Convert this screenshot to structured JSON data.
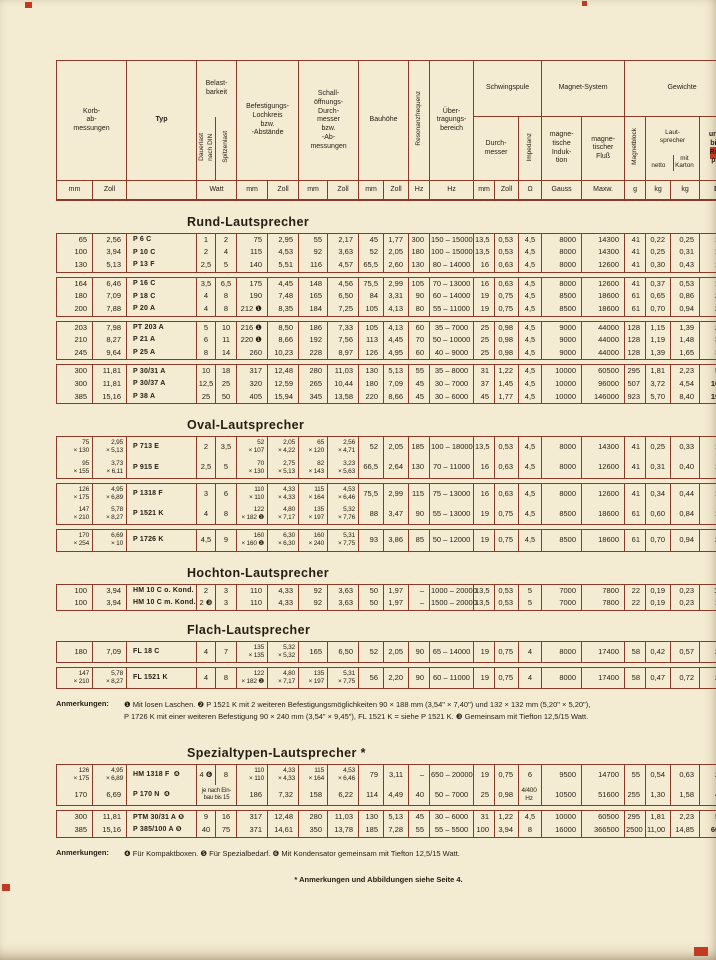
{
  "colors": {
    "paper": "#f3ebd2",
    "rule": "#8a3a26",
    "ink": "#241d12",
    "mark_red": "#c03a24"
  },
  "header": {
    "korb": "Korb-\nab-\nmessungen",
    "typ": "Typ",
    "belastbarkeit": "Belast-\nbarkeit",
    "dauerlast": "Dauerlast\nnach DIN",
    "spitzenlast": "Spitzenlast",
    "befestigung": "Befestigungs-\nLochkreis\nbzw.\n-Abstände",
    "schall": "Schall-\nöffnungs-\nDurch-\nmesser\nbzw.\n-Ab-\nmessungen",
    "bauhoehe": "Bauhöhe",
    "resonanz": "Resonanzfrequenz",
    "uebertragung": "Über-\ntragungs-\nbereich",
    "schwingspule": "Schwingspule",
    "durchmesser": "Durch-\nmesser",
    "impedanz": "Impedanz",
    "magnetsystem": "Magnet-System",
    "induktion": "magne-\ntische\nInduk-\ntion",
    "fluss": "magne-\ntischer\nFluß",
    "gewichte": "Gewichte",
    "magnetblock": "Magnetblock",
    "lautsprecher": "Laut-\nsprecher",
    "netto": "netto",
    "mit_karton": "mit\nKarton",
    "preis": "unver-\nbindl.\nRicht-\npreis",
    "units": [
      "mm",
      "Zoll",
      "Watt",
      "mm",
      "Zoll",
      "mm",
      "Zoll",
      "mm",
      "Zoll",
      "Hz",
      "Hz",
      "mm",
      "Zoll",
      "Ω",
      "Gauss",
      "Maxw.",
      "g",
      "kg",
      "kg",
      "DM"
    ]
  },
  "sections": [
    {
      "title": "Rund-Lautsprecher",
      "groups": [
        [
          [
            "65",
            "2,56",
            "P 6 C",
            "1",
            "2",
            "75",
            "2,95",
            "55",
            "2,17",
            "45",
            "1,77",
            "300",
            "150 – 15000",
            "13,5",
            "0,53",
            "4,5",
            "8000",
            "14300",
            "41",
            "0,22",
            "0,25",
            "14,—"
          ],
          [
            "100",
            "3,94",
            "P 10 C",
            "2",
            "4",
            "115",
            "4,53",
            "92",
            "3,63",
            "52",
            "2,05",
            "180",
            "100 – 15000",
            "13,5",
            "0,53",
            "4,5",
            "8000",
            "14300",
            "41",
            "0,25",
            "0,31",
            "15,—"
          ],
          [
            "130",
            "5,13",
            "P 13 F",
            "2,5",
            "5",
            "140",
            "5,51",
            "116",
            "4,57",
            "65,5",
            "2,60",
            "130",
            "80 – 14000",
            "16",
            "0,63",
            "4,5",
            "8000",
            "12600",
            "41",
            "0,30",
            "0,43",
            "17,—"
          ]
        ],
        [
          [
            "164",
            "6,46",
            "P 16 C",
            "3,5",
            "6,5",
            "175",
            "4,45",
            "148",
            "4,56",
            "75,5",
            "2,99",
            "105",
            "70 – 13000",
            "16",
            "0,63",
            "4,5",
            "8000",
            "12600",
            "41",
            "0,37",
            "0,53",
            "19,—"
          ],
          [
            "180",
            "7,09",
            "P 18 C",
            "4",
            "8",
            "190",
            "7,48",
            "165",
            "6,50",
            "84",
            "3,31",
            "90",
            "60 – 14000",
            "19",
            "0,75",
            "4,5",
            "8500",
            "18600",
            "61",
            "0,65",
            "0,86",
            "21,—"
          ],
          [
            "200",
            "7,88",
            "P 20 A",
            "4",
            "8",
            "212 ❶",
            "8,35",
            "184",
            "7,25",
            "105",
            "4,13",
            "80",
            "55 – 11000",
            "19",
            "0,75",
            "4,5",
            "8500",
            "18600",
            "61",
            "0,70",
            "0,94",
            "22,—"
          ]
        ],
        [
          [
            "203",
            "7,98",
            "PT 203 A",
            "5",
            "10",
            "216 ❶",
            "8,50",
            "186",
            "7,33",
            "105",
            "4,13",
            "60",
            "35 – 7000",
            "25",
            "0,98",
            "4,5",
            "9000",
            "44000",
            "128",
            "1,15",
            "1,39",
            "29,—"
          ],
          [
            "210",
            "8,27",
            "P 21 A",
            "6",
            "11",
            "220 ❶",
            "8,66",
            "192",
            "7,56",
            "113",
            "4,45",
            "70",
            "50 – 10000",
            "25",
            "0,98",
            "4,5",
            "9000",
            "44000",
            "128",
            "1,19",
            "1,48",
            "30,—"
          ],
          [
            "245",
            "9,64",
            "P 25 A",
            "8",
            "14",
            "260",
            "10,23",
            "228",
            "8,97",
            "126",
            "4,95",
            "60",
            "40 – 9000",
            "25",
            "0,98",
            "4,5",
            "9000",
            "44000",
            "128",
            "1,39",
            "1,65",
            "34,—"
          ]
        ],
        [
          [
            "300",
            "11,81",
            "P 30/31 A",
            "10",
            "18",
            "317",
            "12,48",
            "280",
            "11,03",
            "130",
            "5,13",
            "55",
            "35 – 8000",
            "31",
            "1,22",
            "4,5",
            "10000",
            "60500",
            "295",
            "1,81",
            "2,23",
            "51,—"
          ],
          [
            "300",
            "11,81",
            "P 30/37 A",
            "12,5",
            "25",
            "320",
            "12,59",
            "265",
            "10,44",
            "180",
            "7,09",
            "45",
            "30 – 7000",
            "37",
            "1,45",
            "4,5",
            "10000",
            "96000",
            "507",
            "3,72",
            "4,54",
            "102,—"
          ],
          [
            "385",
            "15,16",
            "P 38 A",
            "25",
            "50",
            "405",
            "15,94",
            "345",
            "13,58",
            "220",
            "8,66",
            "45",
            "30 – 6000",
            "45",
            "1,77",
            "4,5",
            "10000",
            "146000",
            "923",
            "5,70",
            "8,40",
            "195,—"
          ]
        ]
      ]
    },
    {
      "title": "Oval-Lautsprecher",
      "groups": [
        [
          [
            "75\n× 130",
            "2,95\n× 5,13",
            "P 713 E",
            "2",
            "3,5",
            "52\n× 107",
            "2,05\n× 4,22",
            "65\n× 120",
            "2,56\n× 4,71",
            "52",
            "2,05",
            "185",
            "100 – 18000",
            "13,5",
            "0,53",
            "4,5",
            "8000",
            "14300",
            "41",
            "0,25",
            "0,33",
            "15,—"
          ],
          [
            "95\n× 155",
            "3,73\n× 6,11",
            "P 915 E",
            "2,5",
            "5",
            "70\n× 130",
            "2,75\n× 5,13",
            "82\n× 143",
            "3,23\n× 5,63",
            "66,5",
            "2,64",
            "130",
            "70 – 11000",
            "16",
            "0,63",
            "4,5",
            "8000",
            "12600",
            "41",
            "0,31",
            "0,40",
            "17,—"
          ]
        ],
        [
          [
            "126\n× 175",
            "4,95\n× 6,89",
            "P 1318 F",
            "3",
            "6",
            "110\n× 110",
            "4,33\n× 4,33",
            "115\n× 164",
            "4,53\n× 6,46",
            "75,5",
            "2,99",
            "115",
            "75 – 13000",
            "16",
            "0,63",
            "4,5",
            "8000",
            "12600",
            "41",
            "0,34",
            "0,44",
            "18,—"
          ],
          [
            "147\n× 210",
            "5,78\n× 8,27",
            "P 1521 K",
            "4",
            "8",
            "122\n× 182 ❷",
            "4,80\n× 7,17",
            "135\n× 197",
            "5,32\n× 7,76",
            "88",
            "3,47",
            "90",
            "55 – 13000",
            "19",
            "0,75",
            "4,5",
            "8500",
            "18600",
            "61",
            "0,60",
            "0,84",
            "19,—"
          ]
        ],
        [
          [
            "170\n× 254",
            "6,69\n× 10",
            "P 1726 K",
            "4,5",
            "9",
            "160\n× 160 ❷",
            "6,30\n× 6,30",
            "160\n× 240",
            "5,31\n× 7,75",
            "93",
            "3,86",
            "85",
            "50 – 12000",
            "19",
            "0,75",
            "4,5",
            "8500",
            "18600",
            "61",
            "0,70",
            "0,94",
            "23,—"
          ]
        ]
      ]
    },
    {
      "title": "Hochton-Lautsprecher",
      "groups": [
        [
          [
            "100",
            "3,94",
            "HM 10 C o. Kond.",
            "2",
            "3",
            "110",
            "4,33",
            "92",
            "3,63",
            "50",
            "1,97",
            "–",
            "1000 – 20000",
            "13,5",
            "0,53",
            "5",
            "7000",
            "7800",
            "22",
            "0,19",
            "0,23",
            "10,50"
          ],
          [
            "100",
            "3,94",
            "HM 10 C m. Kond.",
            "2 ❸",
            "3",
            "110",
            "4,33",
            "92",
            "3,63",
            "50",
            "1,97",
            "–",
            "1500 – 20000",
            "13,5",
            "0,53",
            "5",
            "7000",
            "7800",
            "22",
            "0,19",
            "0,23",
            "12,—"
          ]
        ]
      ]
    },
    {
      "title": "Flach-Lautsprecher",
      "groups": [
        [
          [
            "180",
            "7,09",
            "FL 18 C",
            "4",
            "7",
            "135\n× 135",
            "5,32\n× 5,32",
            "165",
            "6,50",
            "52",
            "2,05",
            "90",
            "65 – 14000",
            "19",
            "0,75",
            "4",
            "8000",
            "17400",
            "58",
            "0,42",
            "0,57",
            "22,—"
          ]
        ],
        [
          [
            "147\n× 210",
            "5,78\n× 8,27",
            "FL 1521 K",
            "4",
            "8",
            "122\n× 182 ❷",
            "4,80\n× 7,17",
            "135\n× 197",
            "5,31\n× 7,75",
            "56",
            "2,20",
            "90",
            "60 – 11000",
            "19",
            "0,75",
            "4",
            "8000",
            "17400",
            "58",
            "0,47",
            "0,72",
            "22,—"
          ]
        ]
      ]
    },
    {
      "title": "Spezialtypen-Lautsprecher *",
      "groups": [
        [
          [
            "126\n× 175",
            "4,95\n× 6,89",
            "HM 1318 F  ❹",
            "4 ❻",
            "8",
            "110\n× 110",
            "4,33\n× 4,33",
            "115\n× 164",
            "4,53\n× 6,46",
            "79",
            "3,11",
            "–",
            "650 – 20000",
            "19",
            "0,75",
            "6",
            "9500",
            "14700",
            "55",
            "0,54",
            "0,63",
            "20,—"
          ],
          [
            "170",
            "6,69",
            "P 170 N  ❹",
            "je nach Ein-\nbau bis 15",
            null,
            "186",
            "7,32",
            "158",
            "6,22",
            "114",
            "4,49",
            "40",
            "50 – 7000",
            "25",
            "0,98",
            "4/400\nHz",
            "10500",
            "51600",
            "255",
            "1,30",
            "1,58",
            "45,—"
          ]
        ],
        [
          [
            "300",
            "11,81",
            "PTM 30/31 A ❺",
            "9",
            "16",
            "317",
            "12,48",
            "280",
            "11,03",
            "130",
            "5,13",
            "45",
            "30 – 6000",
            "31",
            "1,22",
            "4,5",
            "10000",
            "60500",
            "295",
            "1,81",
            "2,23",
            "58,—"
          ],
          [
            "385",
            "15,16",
            "P 385/100 A ❺",
            "40",
            "75",
            "371",
            "14,61",
            "350",
            "13,78",
            "185",
            "7,28",
            "55",
            "55 – 5500",
            "100",
            "3,94",
            "8",
            "16000",
            "366500",
            "2500",
            "11,00",
            "14,85",
            "660,—"
          ]
        ]
      ]
    }
  ],
  "notes_mid": {
    "label": "Anmerkungen:",
    "text": "❶ Mit losen Laschen.  ❷ P 1521 K mit 2 weiteren Befestigungsmöglichkeiten 90 × 188 mm (3,54\" × 7,40\") und 132 × 132 mm (5,20\" × 5,20\"),\nP 1726 K mit einer weiteren Befestigung 90 × 240 mm (3,54\" × 9,45\"), FL 1521 K = siehe P 1521 K.  ❸ Gemeinsam mit Tiefton 12,5/15 Watt."
  },
  "notes_bottom": {
    "label": "Anmerkungen:",
    "text": "❹ Für Kompaktboxen.  ❺ Für Spezialbedarf.  ❻ Mit Kondensator gemeinsam mit Tiefton 12,5/15 Watt."
  },
  "star_note": "* Anmerkungen und Abbildungen siehe Seite 4."
}
